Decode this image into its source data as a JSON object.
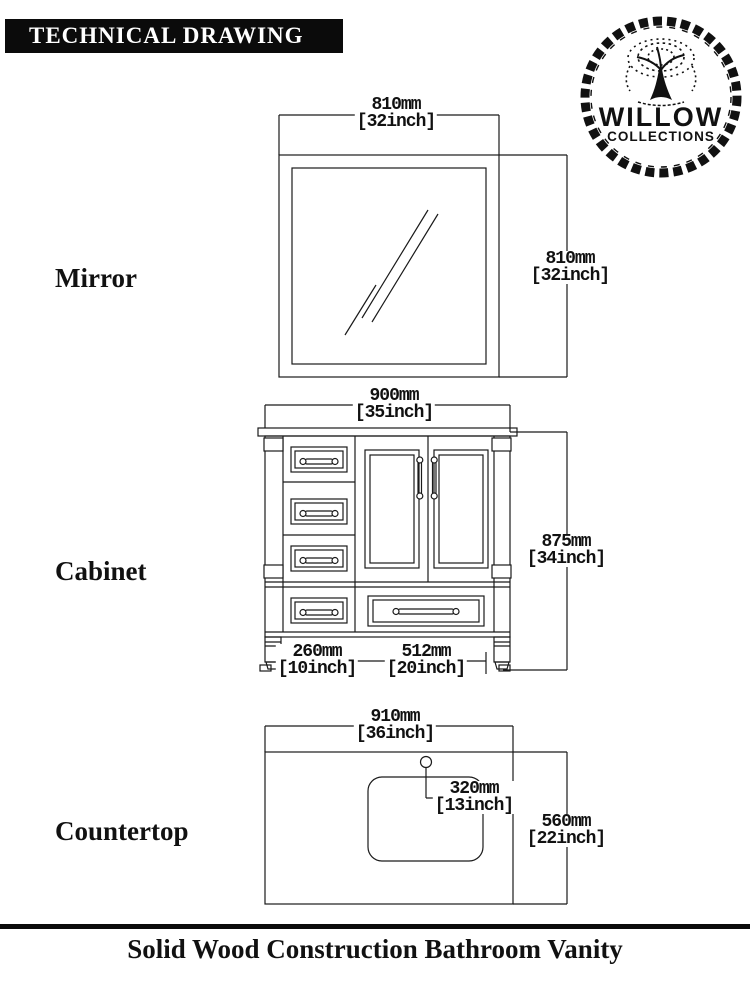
{
  "header": {
    "title": "TECHNICAL DRAWING",
    "logo": {
      "brand": "WILLOW",
      "sub": "COLLECTIONS"
    }
  },
  "colors": {
    "ink": "#111111",
    "background": "#ffffff"
  },
  "sections": [
    {
      "label": "Mirror",
      "dims": {
        "width": {
          "mm": "810mm",
          "inch": "[32inch]"
        },
        "height": {
          "mm": "810mm",
          "inch": "[32inch]"
        }
      }
    },
    {
      "label": "Cabinet",
      "dims": {
        "width": {
          "mm": "900mm",
          "inch": "[35inch]"
        },
        "height": {
          "mm": "875mm",
          "inch": "[34inch]"
        },
        "drawer_width": {
          "mm": "260mm",
          "inch": "[10inch]"
        },
        "door_width": {
          "mm": "512mm",
          "inch": "[20inch]"
        }
      }
    },
    {
      "label": "Countertop",
      "dims": {
        "width": {
          "mm": "910mm",
          "inch": "[36inch]"
        },
        "depth": {
          "mm": "560mm",
          "inch": "[22inch]"
        },
        "sink_offset": {
          "mm": "320mm",
          "inch": "[13inch]"
        }
      }
    }
  ],
  "footer": {
    "caption": "Solid Wood Construction Bathroom Vanity"
  }
}
